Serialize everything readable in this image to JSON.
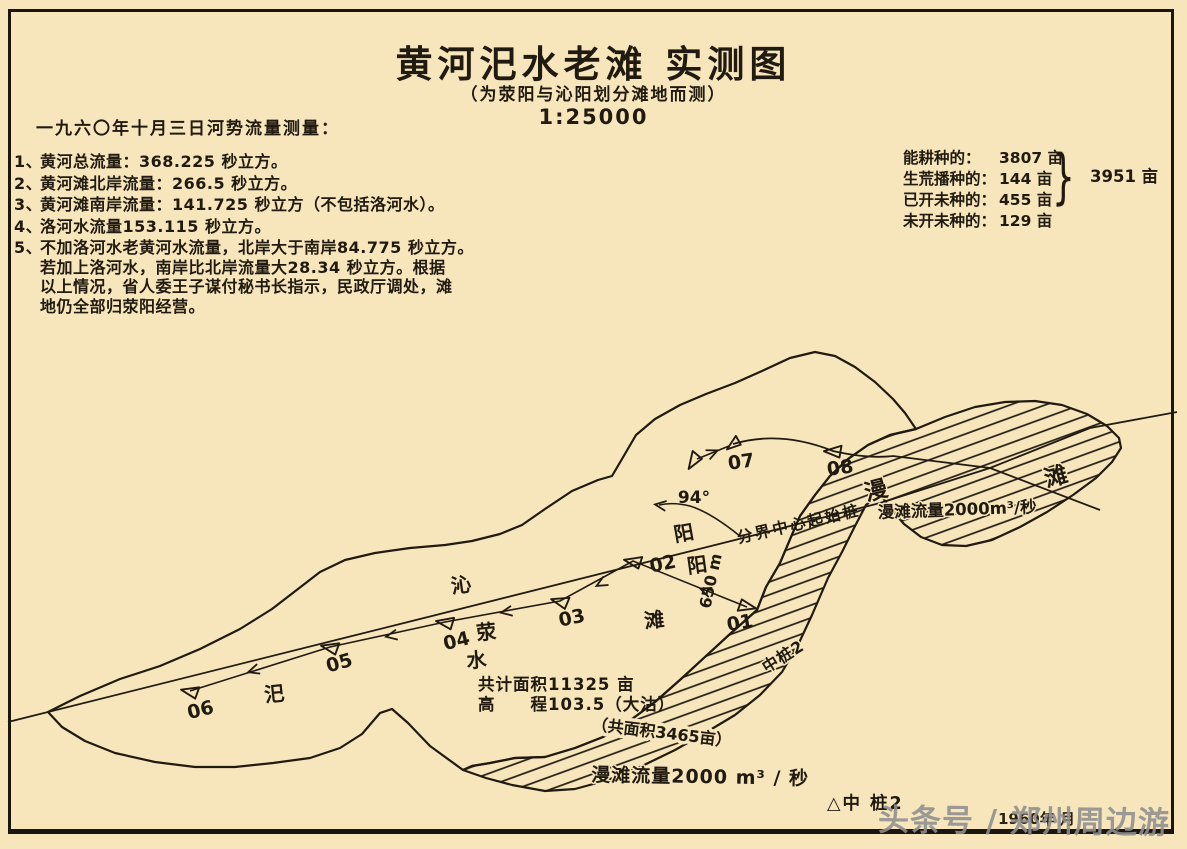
{
  "page": {
    "bg": "#f7e6bc",
    "ink": "#211a10",
    "watermark_color": "#8f8f8f"
  },
  "title": {
    "main": "黄河汜水老滩 实测图",
    "sub": "（为荥阳与沁阳划分滩地而测）",
    "scale": "1:25000"
  },
  "notes": {
    "heading": "一九六〇年十月三日河势流量测量：",
    "items": [
      {
        "num": "1、",
        "lines": [
          "黄河总流量：368.225 秒立方。"
        ]
      },
      {
        "num": "2、",
        "lines": [
          "黄河滩北岸流量：266.5 秒立方。"
        ]
      },
      {
        "num": "3、",
        "lines": [
          "黄河滩南岸流量：141.725 秒立方（不包括洛河水）。"
        ]
      },
      {
        "num": "4、",
        "lines": [
          "洛河水流量153.115 秒立方。"
        ]
      },
      {
        "num": "5、",
        "lines": [
          "不加洛河水老黄河水流量，北岸大于南岸84.775 秒立方。",
          "若加上洛河水，南岸比北岸流量大28.34 秒立方。根据",
          "以上情况，省人委王子谋付秘书长指示，民政厅调处，滩",
          "地仍全部归荥阳经营。"
        ]
      }
    ]
  },
  "stats": {
    "rows": [
      {
        "label": "能耕种的：",
        "value": "3807 亩"
      },
      {
        "label": "生荒播种的：",
        "value": "144  亩"
      },
      {
        "label": "已开未种的：",
        "value": "455 亩"
      },
      {
        "label": "未开未种的：",
        "value": "129 亩"
      }
    ],
    "brace": "}",
    "total": "3951 亩"
  },
  "map": {
    "markers": {
      "m01": "01",
      "m02": "02",
      "m03": "03",
      "m04": "04",
      "m05": "05",
      "m06": "06",
      "m07": "07",
      "m08": "08"
    },
    "chars": {
      "si": "汜",
      "shui": "水",
      "xing": "荥",
      "qin": "沁",
      "yang_north": "阳",
      "yang_south": "阳",
      "tan": "滩",
      "blob_man": "漫",
      "blob_tan": "滩"
    },
    "texts": {
      "angle": "94°",
      "distance": "650 m",
      "boundary": "分界中心起始桩",
      "pile": "中桩2",
      "area_line1": "共计面积11325  亩",
      "area_line2": "高　　程103.5（大沽）",
      "band_area": "（共面积3465亩）",
      "band_flow": "漫滩流量2000 m³ / 秒",
      "blob_flow": "漫滩流量2000m³/秒",
      "legend": "△中  桩2"
    }
  },
  "watermark": {
    "text": "头条号 / 郑州周边游",
    "underlay": "1960年 月"
  }
}
